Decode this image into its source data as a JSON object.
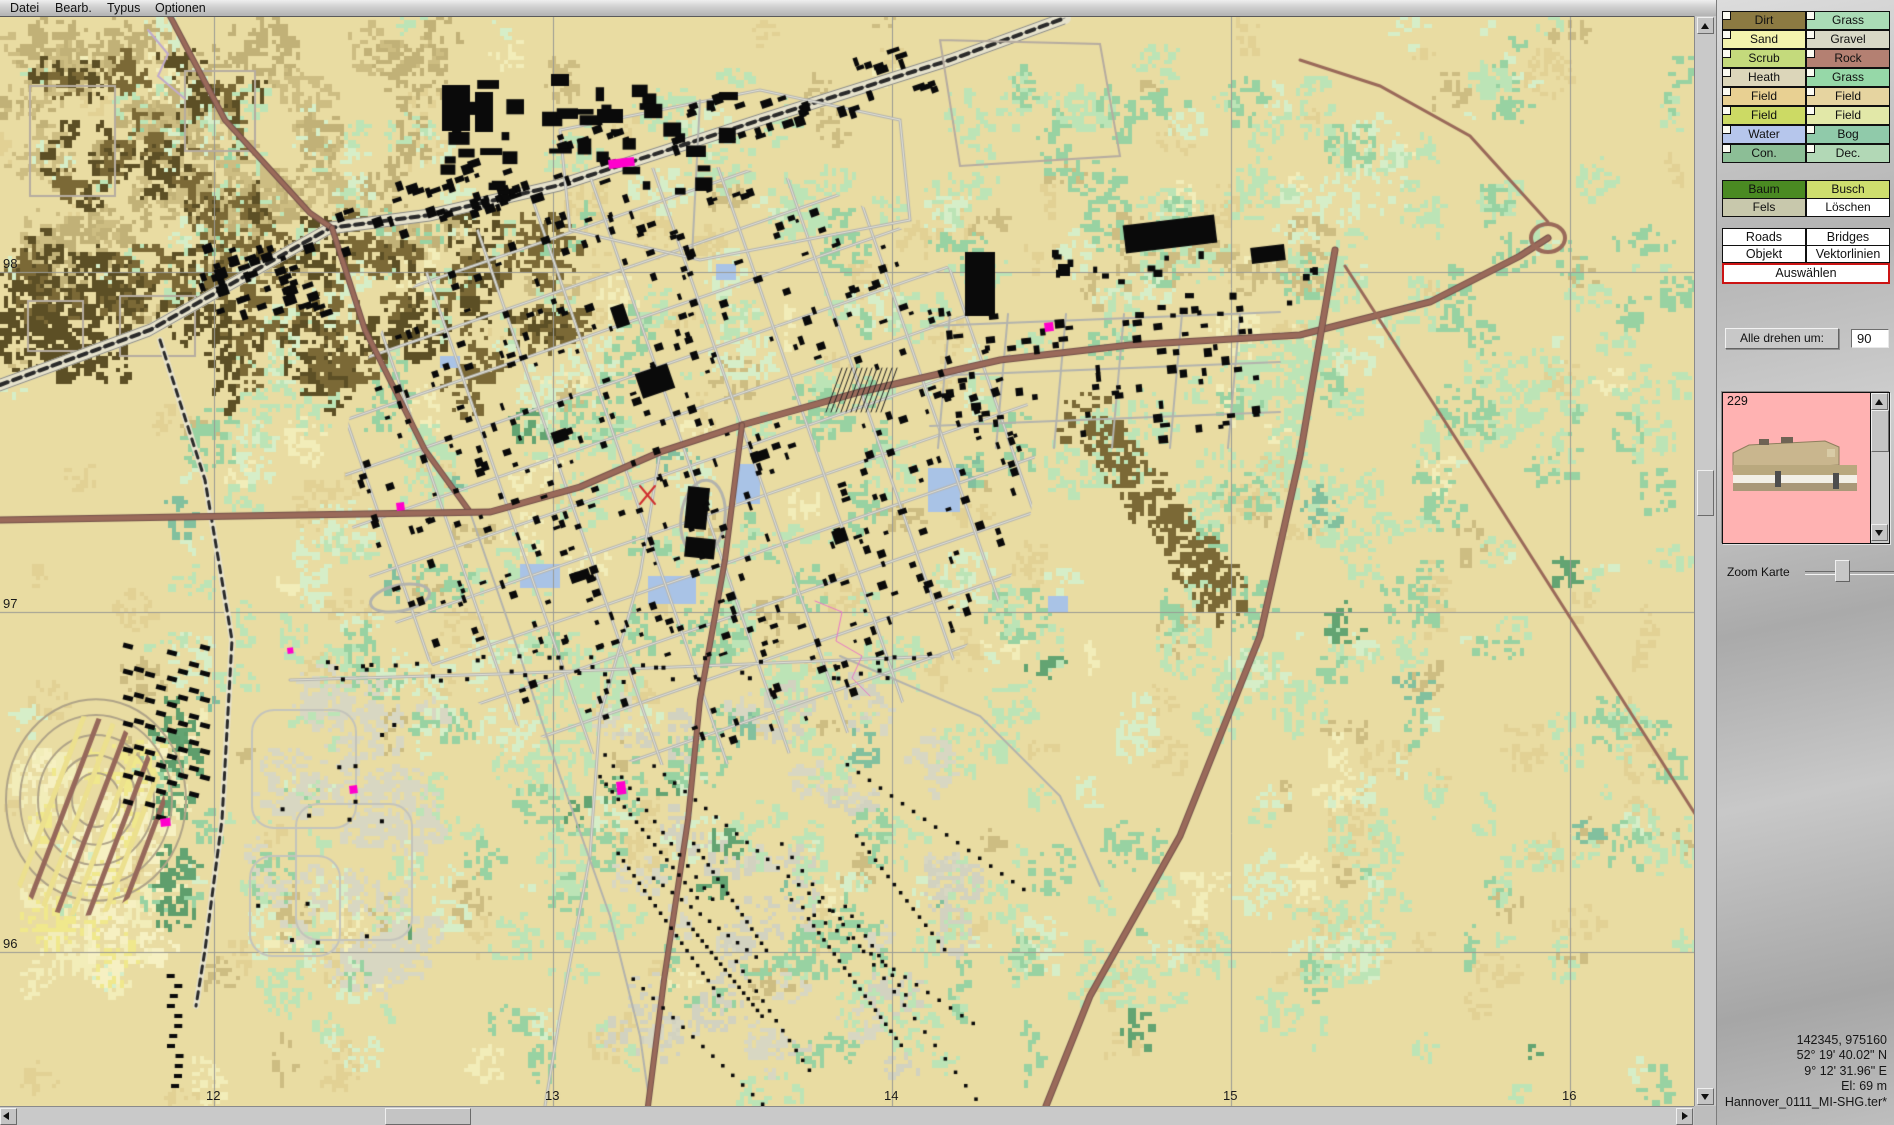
{
  "menu": {
    "items": [
      {
        "label": "Datei"
      },
      {
        "label": "Bearb."
      },
      {
        "label": "Typus"
      },
      {
        "label": "Optionen"
      }
    ]
  },
  "map": {
    "grid_x": [
      {
        "label": "12",
        "x": 214
      },
      {
        "label": "13",
        "x": 553
      },
      {
        "label": "14",
        "x": 892
      },
      {
        "label": "15",
        "x": 1231
      },
      {
        "label": "16",
        "x": 1570
      }
    ],
    "grid_y": [
      {
        "label": "98",
        "y": 256
      },
      {
        "label": "97",
        "y": 596
      },
      {
        "label": "96",
        "y": 936
      }
    ],
    "palette": {
      "sand": "#e9dca2",
      "sand2": "#e2d194",
      "khaki": "#cdbd82",
      "cream": "#f2edb9",
      "light_green": "#bce4b6",
      "green": "#98d2a2",
      "pale_green": "#d6eec8",
      "teal": "#82c09e",
      "dark_green": "#63a472",
      "forest_brown": "#7b6936",
      "dark_brown": "#5c4f25",
      "residential": "#d8d7c2",
      "water": "#a9c3e6",
      "road_minor": "#b3b3ad",
      "road_major": "#9a6a5a",
      "rail": "#2a2a2a",
      "building": "#0a0a0a",
      "object_marker": "#ff00cc",
      "grid_line": "#9a9a94"
    }
  },
  "panel": {
    "terrain_buttons": [
      {
        "label": "Dirt",
        "color": "#8c7a42"
      },
      {
        "label": "Grass",
        "color": "#aadcb6"
      },
      {
        "label": "Sand",
        "color": "#f4f4ae"
      },
      {
        "label": "Gravel",
        "color": "#d8d8c6"
      },
      {
        "label": "Scrub",
        "color": "#c4da7c"
      },
      {
        "label": "Rock",
        "color": "#b48072"
      },
      {
        "label": "Heath",
        "color": "#dcd6ba"
      },
      {
        "label": "Grass",
        "color": "#96d8a8"
      },
      {
        "label": "Field",
        "color": "#e8d092"
      },
      {
        "label": "Field",
        "color": "#e6d4a0"
      },
      {
        "label": "Field",
        "color": "#ccda64"
      },
      {
        "label": "Field",
        "color": "#e2e8a8"
      },
      {
        "label": "Water",
        "color": "#b6c6ec"
      },
      {
        "label": "Bog",
        "color": "#90caaa"
      },
      {
        "label": "Con.",
        "color": "#8cbe96"
      },
      {
        "label": "Dec.",
        "color": "#b2d8b6"
      }
    ],
    "paint_buttons": [
      {
        "label": "Baum",
        "color": "#4a8a22"
      },
      {
        "label": "Busch",
        "color": "#cede6e"
      },
      {
        "label": "Fels",
        "color": "#c8c8ac"
      },
      {
        "label": "Löschen",
        "color": "#ffffff"
      }
    ],
    "tool_buttons": [
      {
        "label": "Roads"
      },
      {
        "label": "Bridges"
      },
      {
        "label": "Objekt"
      },
      {
        "label": "Vektorlinien"
      }
    ],
    "select_button": {
      "label": "Auswählen",
      "border_color": "#cc1414"
    },
    "rotate": {
      "button_label": "Alle drehen um:",
      "value": "90"
    },
    "preview": {
      "number": "229",
      "background": "#ffb2b2",
      "object_color": "#c9b68e"
    },
    "zoom": {
      "label": "Zoom Karte"
    },
    "status": {
      "coords": "142345, 975160",
      "lat": "52° 19' 40.02\" N",
      "lon": "9° 12' 31.96\" E",
      "elevation": "El: 69 m",
      "filename": "Hannover_0111_MI-SHG.ter*"
    }
  }
}
